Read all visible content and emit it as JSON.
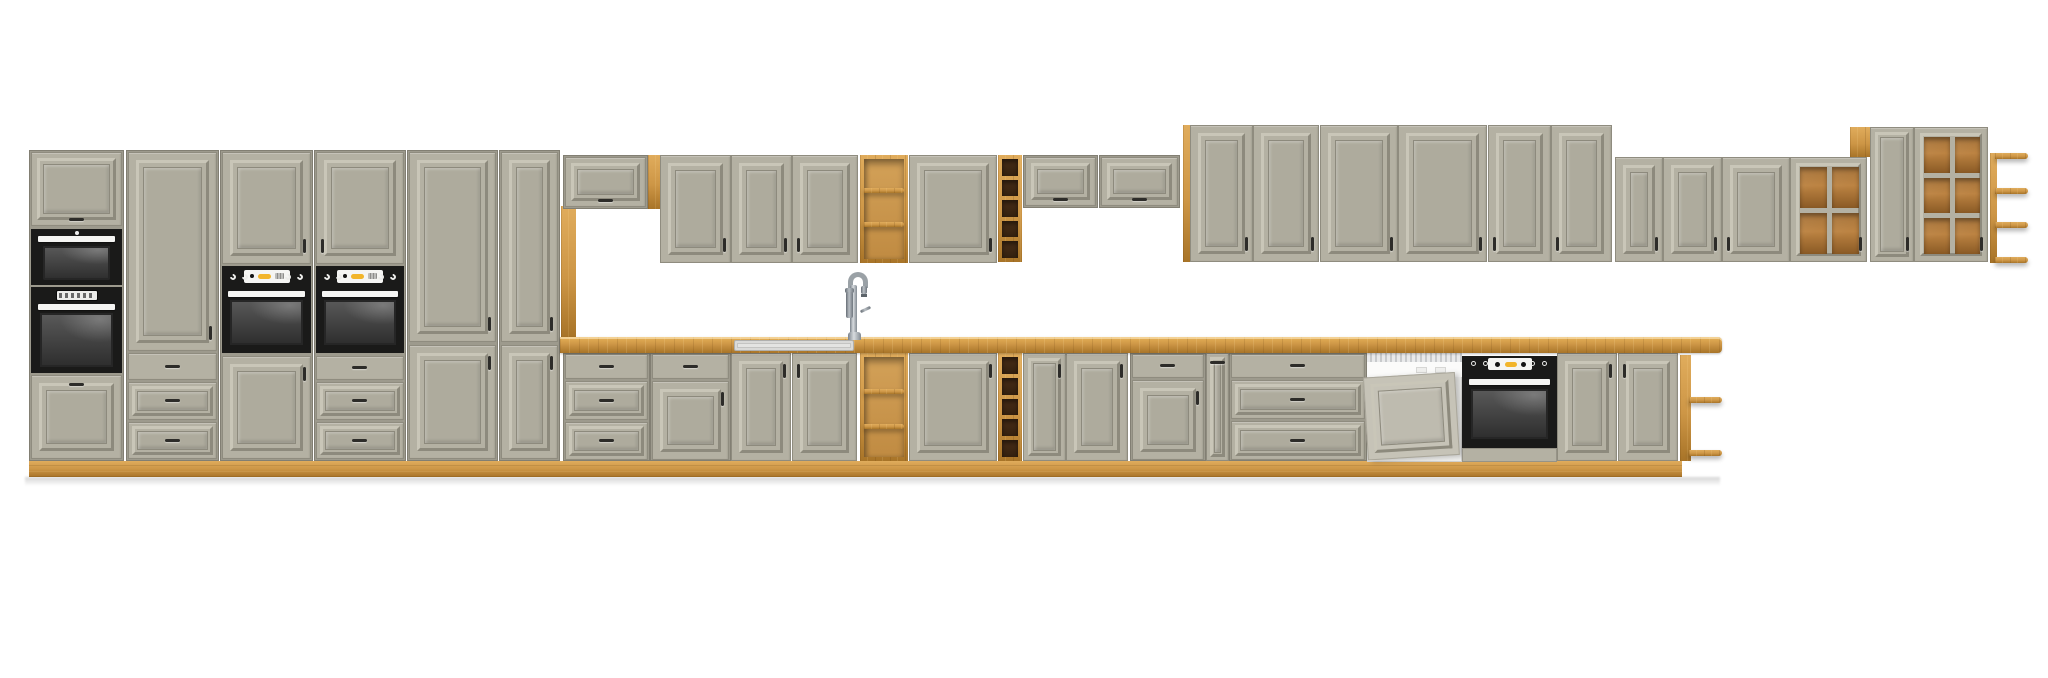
{
  "canvas": {
    "w": 2048,
    "h": 678,
    "bg": "#ffffff"
  },
  "palette": {
    "bg": "#ffffff",
    "front": "#b4b1a3",
    "frontField": "#aeab9d",
    "mLight": "#c9c6b8",
    "mDark": "#8d8a7d",
    "carcass": "#9d9a8d",
    "edge": "#8f8c7f",
    "wood": "#cd9646",
    "woodL": "#e0ac5c",
    "woodD": "#a87428",
    "black": "#1a1a19",
    "win": "#3f3f3f",
    "white": "#f5f5f3",
    "yellow": "#f2b52b",
    "dwPanel": "#c6c3b7",
    "dwPanelField": "#bebbaf"
  },
  "elements": [
    {
      "t": "shadow",
      "n": "floor-shadow",
      "x": 25,
      "y": 477,
      "w": 1695,
      "h": 9
    },
    {
      "t": "wood",
      "n": "plinth",
      "x": 29,
      "y": 461,
      "w": 1653,
      "h": 16,
      "o": {
        "g": "h"
      }
    },
    {
      "t": "box",
      "n": "tall-unit-appliance-housing",
      "x": 29,
      "y": 150,
      "w": 95,
      "h": 311
    },
    {
      "t": "flap",
      "n": "flap-door",
      "x": 31,
      "y": 152,
      "w": 91,
      "h": 74
    },
    {
      "t": "mw",
      "n": "microwave",
      "x": 31,
      "y": 229,
      "w": 91,
      "h": 56
    },
    {
      "t": "ovenT",
      "n": "built-in-oven-left",
      "x": 31,
      "y": 287,
      "w": 91,
      "h": 86
    },
    {
      "t": "door",
      "n": "cabinet-door",
      "x": 31,
      "y": 375,
      "w": 91,
      "h": 84,
      "o": {
        "h": "tc"
      }
    },
    {
      "t": "box",
      "n": "tall-unit-pantry",
      "x": 126,
      "y": 150,
      "w": 93,
      "h": 311
    },
    {
      "t": "door",
      "n": "cabinet-door",
      "x": 128,
      "y": 152,
      "w": 89,
      "h": 199,
      "o": {
        "h": "br"
      }
    },
    {
      "t": "drawerP",
      "n": "drawer",
      "x": 128,
      "y": 353,
      "w": 89,
      "h": 27
    },
    {
      "t": "drawerM",
      "n": "drawer",
      "x": 128,
      "y": 382,
      "w": 89,
      "h": 38
    },
    {
      "t": "drawerM",
      "n": "drawer",
      "x": 128,
      "y": 422,
      "w": 89,
      "h": 37
    },
    {
      "t": "box",
      "n": "tall-unit-oven-housing-a",
      "x": 220,
      "y": 150,
      "w": 93,
      "h": 311
    },
    {
      "t": "door",
      "n": "cabinet-door",
      "x": 222,
      "y": 152,
      "w": 89,
      "h": 112,
      "o": {
        "h": "br"
      }
    },
    {
      "t": "ovenC",
      "n": "oven-control-panel",
      "x": 222,
      "y": 266,
      "w": 89,
      "h": 21
    },
    {
      "t": "ovenW",
      "n": "oven-door-window",
      "x": 222,
      "y": 287,
      "w": 89,
      "h": 66
    },
    {
      "t": "door",
      "n": "cabinet-door",
      "x": 222,
      "y": 356,
      "w": 89,
      "h": 103,
      "o": {
        "h": "tr"
      }
    },
    {
      "t": "box",
      "n": "tall-unit-oven-housing-b",
      "x": 314,
      "y": 150,
      "w": 92,
      "h": 311
    },
    {
      "t": "door",
      "n": "cabinet-door",
      "x": 316,
      "y": 152,
      "w": 88,
      "h": 112,
      "o": {
        "h": "bl"
      }
    },
    {
      "t": "ovenC",
      "n": "oven-control-panel",
      "x": 316,
      "y": 266,
      "w": 88,
      "h": 21
    },
    {
      "t": "ovenW",
      "n": "oven-door-window",
      "x": 316,
      "y": 287,
      "w": 88,
      "h": 66
    },
    {
      "t": "drawerP",
      "n": "drawer",
      "x": 316,
      "y": 356,
      "w": 88,
      "h": 24
    },
    {
      "t": "drawerM",
      "n": "drawer",
      "x": 316,
      "y": 382,
      "w": 88,
      "h": 38
    },
    {
      "t": "drawerM",
      "n": "drawer",
      "x": 316,
      "y": 422,
      "w": 88,
      "h": 37
    },
    {
      "t": "box",
      "n": "tall-unit-2door-a",
      "x": 407,
      "y": 150,
      "w": 91,
      "h": 311
    },
    {
      "t": "door",
      "n": "cabinet-door",
      "x": 409,
      "y": 152,
      "w": 87,
      "h": 190,
      "o": {
        "h": "br"
      }
    },
    {
      "t": "door",
      "n": "cabinet-door",
      "x": 409,
      "y": 345,
      "w": 87,
      "h": 114,
      "o": {
        "h": "tr"
      }
    },
    {
      "t": "box",
      "n": "tall-unit-2door-b",
      "x": 499,
      "y": 150,
      "w": 61,
      "h": 311
    },
    {
      "t": "door",
      "n": "cabinet-door",
      "x": 501,
      "y": 152,
      "w": 57,
      "h": 190,
      "o": {
        "h": "br"
      }
    },
    {
      "t": "door",
      "n": "cabinet-door",
      "x": 501,
      "y": 345,
      "w": 57,
      "h": 114,
      "o": {
        "h": "tr"
      }
    },
    {
      "t": "wood",
      "n": "side-panel",
      "x": 561,
      "y": 206,
      "w": 15,
      "h": 131,
      "o": {
        "g": "v"
      }
    },
    {
      "t": "box",
      "n": "wall-flap-cabinet",
      "x": 563,
      "y": 155,
      "w": 85,
      "h": 54
    },
    {
      "t": "flap",
      "n": "flap-door",
      "x": 565,
      "y": 157,
      "w": 81,
      "h": 50
    },
    {
      "t": "wood",
      "n": "side-panel",
      "x": 648,
      "y": 155,
      "w": 12,
      "h": 54,
      "o": {
        "g": "v"
      }
    },
    {
      "t": "door",
      "n": "wall-cabinet-door",
      "x": 660,
      "y": 155,
      "w": 71,
      "h": 108,
      "o": {
        "h": "br"
      }
    },
    {
      "t": "door",
      "n": "wall-cabinet-door",
      "x": 731,
      "y": 155,
      "w": 61,
      "h": 108,
      "o": {
        "h": "br"
      }
    },
    {
      "t": "door",
      "n": "wall-cabinet-door",
      "x": 792,
      "y": 155,
      "w": 66,
      "h": 108,
      "o": {
        "h": "bl"
      }
    },
    {
      "t": "shelfO",
      "n": "wall-open-shelf",
      "x": 860,
      "y": 155,
      "w": 48,
      "h": 108,
      "o": {
        "b": [
          33,
          67
        ]
      }
    },
    {
      "t": "door",
      "n": "wall-cabinet-door",
      "x": 909,
      "y": 155,
      "w": 88,
      "h": 108,
      "o": {
        "h": "br"
      }
    },
    {
      "t": "wine",
      "n": "wall-wine-rack",
      "x": 998,
      "y": 155,
      "w": 24,
      "h": 107
    },
    {
      "t": "box",
      "n": "wall-flap-cabinet",
      "x": 1023,
      "y": 155,
      "w": 75,
      "h": 53
    },
    {
      "t": "flap",
      "n": "flap-door",
      "x": 1025,
      "y": 157,
      "w": 71,
      "h": 49
    },
    {
      "t": "box",
      "n": "wall-flap-cabinet",
      "x": 1099,
      "y": 155,
      "w": 81,
      "h": 53
    },
    {
      "t": "flap",
      "n": "flap-door",
      "x": 1101,
      "y": 157,
      "w": 77,
      "h": 49
    },
    {
      "t": "wood",
      "n": "side-panel",
      "x": 1183,
      "y": 125,
      "w": 7,
      "h": 137,
      "o": {
        "g": "v"
      }
    },
    {
      "t": "door",
      "n": "wall-cabinet-door",
      "x": 1190,
      "y": 125,
      "w": 63,
      "h": 137,
      "o": {
        "h": "br"
      }
    },
    {
      "t": "door",
      "n": "wall-cabinet-door",
      "x": 1253,
      "y": 125,
      "w": 66,
      "h": 137,
      "o": {
        "h": "br"
      }
    },
    {
      "t": "door",
      "n": "wall-cabinet-door",
      "x": 1320,
      "y": 125,
      "w": 78,
      "h": 137,
      "o": {
        "h": "br"
      }
    },
    {
      "t": "door",
      "n": "wall-cabinet-door",
      "x": 1398,
      "y": 125,
      "w": 89,
      "h": 137,
      "o": {
        "h": "br"
      }
    },
    {
      "t": "door",
      "n": "wall-cabinet-door",
      "x": 1488,
      "y": 125,
      "w": 63,
      "h": 137,
      "o": {
        "h": "bl"
      }
    },
    {
      "t": "door",
      "n": "wall-cabinet-door",
      "x": 1551,
      "y": 125,
      "w": 61,
      "h": 137,
      "o": {
        "h": "bl"
      }
    },
    {
      "t": "door",
      "n": "wall-cabinet-door",
      "x": 1615,
      "y": 157,
      "w": 48,
      "h": 105,
      "o": {
        "h": "br"
      }
    },
    {
      "t": "door",
      "n": "wall-cabinet-door",
      "x": 1663,
      "y": 157,
      "w": 59,
      "h": 105,
      "o": {
        "h": "br"
      }
    },
    {
      "t": "door",
      "n": "wall-cabinet-door",
      "x": 1722,
      "y": 157,
      "w": 68,
      "h": 105,
      "o": {
        "h": "bl"
      }
    },
    {
      "t": "glass",
      "n": "glass-door-cabinet",
      "x": 1790,
      "y": 157,
      "w": 77,
      "h": 105,
      "o": {
        "c": 2,
        "r": 2,
        "h": "br"
      }
    },
    {
      "t": "wood",
      "n": "top-filler",
      "x": 1850,
      "y": 127,
      "w": 22,
      "h": 30,
      "o": {
        "g": "v"
      }
    },
    {
      "t": "door",
      "n": "wall-cabinet-door",
      "x": 1870,
      "y": 127,
      "w": 44,
      "h": 135,
      "o": {
        "h": "br"
      }
    },
    {
      "t": "glass",
      "n": "glass-door-cabinet",
      "x": 1914,
      "y": 127,
      "w": 74,
      "h": 135,
      "o": {
        "c": 2,
        "r": 3,
        "h": "br"
      }
    },
    {
      "t": "endshelf",
      "n": "wall-end-shelf",
      "x": 1990,
      "y": 153,
      "w": 38,
      "h": 110,
      "o": {
        "p": 7,
        "b": [
          0,
          35,
          69,
          104
        ]
      }
    },
    {
      "t": "box",
      "n": "base-drawer-unit",
      "x": 563,
      "y": 353,
      "w": 87,
      "h": 108
    },
    {
      "t": "drawerP",
      "n": "drawer",
      "x": 565,
      "y": 354,
      "w": 83,
      "h": 25
    },
    {
      "t": "drawerM",
      "n": "drawer",
      "x": 565,
      "y": 381,
      "w": 83,
      "h": 39
    },
    {
      "t": "drawerM",
      "n": "drawer",
      "x": 565,
      "y": 422,
      "w": 83,
      "h": 38
    },
    {
      "t": "box",
      "n": "base-drawer-door-unit",
      "x": 650,
      "y": 353,
      "w": 81,
      "h": 108
    },
    {
      "t": "drawerP",
      "n": "drawer",
      "x": 652,
      "y": 354,
      "w": 77,
      "h": 25
    },
    {
      "t": "door",
      "n": "base-cabinet-door",
      "x": 652,
      "y": 381,
      "w": 77,
      "h": 79,
      "o": {
        "h": "tr"
      }
    },
    {
      "t": "door",
      "n": "sink-base-door",
      "x": 731,
      "y": 353,
      "w": 60,
      "h": 108,
      "o": {
        "h": "tr"
      }
    },
    {
      "t": "door",
      "n": "sink-base-door",
      "x": 792,
      "y": 353,
      "w": 65,
      "h": 108,
      "o": {
        "h": "tl"
      }
    },
    {
      "t": "shelfO",
      "n": "base-open-shelf",
      "x": 860,
      "y": 353,
      "w": 48,
      "h": 108,
      "o": {
        "b": [
          36,
          71
        ]
      }
    },
    {
      "t": "door",
      "n": "base-cabinet-door",
      "x": 909,
      "y": 353,
      "w": 88,
      "h": 108,
      "o": {
        "h": "tr"
      }
    },
    {
      "t": "wine",
      "n": "base-wine-rack",
      "x": 998,
      "y": 353,
      "w": 24,
      "h": 108
    },
    {
      "t": "door",
      "n": "base-cabinet-door",
      "x": 1023,
      "y": 353,
      "w": 43,
      "h": 108,
      "o": {
        "h": "tr"
      }
    },
    {
      "t": "door",
      "n": "base-cabinet-door",
      "x": 1066,
      "y": 353,
      "w": 62,
      "h": 108,
      "o": {
        "h": "tr"
      }
    },
    {
      "t": "box",
      "n": "base-drawer-door-unit",
      "x": 1130,
      "y": 353,
      "w": 76,
      "h": 108
    },
    {
      "t": "drawerP",
      "n": "drawer",
      "x": 1132,
      "y": 354,
      "w": 72,
      "h": 24
    },
    {
      "t": "door",
      "n": "base-cabinet-door",
      "x": 1132,
      "y": 380,
      "w": 72,
      "h": 80,
      "o": {
        "h": "tr"
      }
    },
    {
      "t": "door",
      "n": "base-filler-door",
      "x": 1206,
      "y": 353,
      "w": 23,
      "h": 108,
      "o": {
        "h": "tc",
        "thin": 1
      }
    },
    {
      "t": "box",
      "n": "base-drawer-unit-wide",
      "x": 1229,
      "y": 353,
      "w": 138,
      "h": 108
    },
    {
      "t": "drawerP",
      "n": "drawer",
      "x": 1231,
      "y": 354,
      "w": 134,
      "h": 24
    },
    {
      "t": "drawerM",
      "n": "drawer",
      "x": 1231,
      "y": 380,
      "w": 134,
      "h": 39
    },
    {
      "t": "drawerM",
      "n": "drawer",
      "x": 1231,
      "y": 421,
      "w": 134,
      "h": 39
    },
    {
      "t": "dw",
      "n": "dishwasher",
      "x": 1367,
      "y": 352,
      "w": 95,
      "h": 110
    },
    {
      "t": "ovenB",
      "n": "built-in-oven-right",
      "x": 1462,
      "y": 352,
      "w": 95,
      "h": 110
    },
    {
      "t": "door",
      "n": "base-cabinet-door",
      "x": 1557,
      "y": 353,
      "w": 60,
      "h": 108,
      "o": {
        "h": "tr"
      }
    },
    {
      "t": "door",
      "n": "base-cabinet-door",
      "x": 1618,
      "y": 353,
      "w": 60,
      "h": 108,
      "o": {
        "h": "tl"
      }
    },
    {
      "t": "endshelf",
      "n": "base-end-shelf",
      "x": 1680,
      "y": 355,
      "w": 42,
      "h": 106,
      "o": {
        "p": 11,
        "b": [
          42,
          95
        ]
      }
    },
    {
      "t": "counter",
      "n": "countertop",
      "x": 560,
      "y": 337,
      "w": 1162,
      "h": 16
    },
    {
      "t": "sink",
      "n": "sink",
      "x": 734,
      "y": 340,
      "w": 120,
      "h": 11
    },
    {
      "t": "faucet",
      "n": "faucet",
      "x": 840,
      "y": 272,
      "w": 30,
      "h": 68
    }
  ]
}
